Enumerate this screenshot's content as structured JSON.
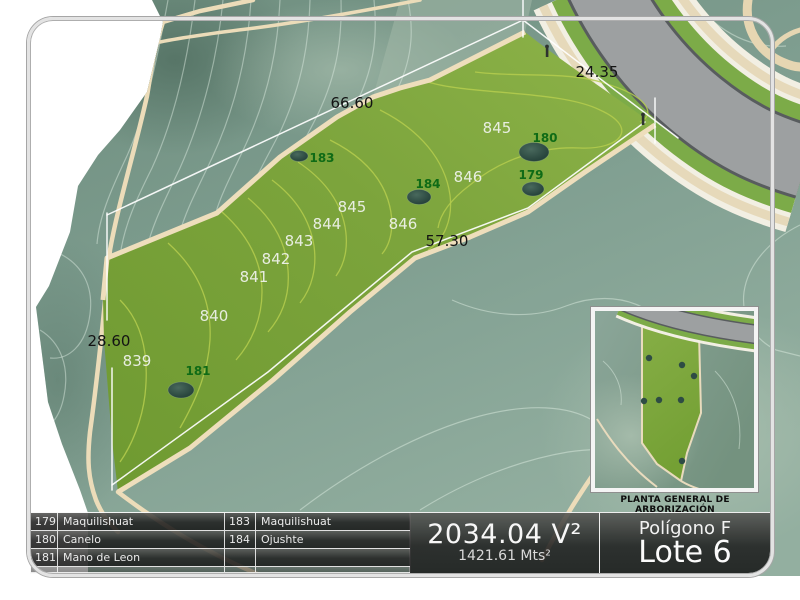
{
  "map": {
    "dimension_labels": [
      "66.60",
      "24.35",
      "57.30",
      "28.60"
    ],
    "elevation_labels": [
      "845",
      "846",
      "845",
      "846",
      "844",
      "843",
      "842",
      "841",
      "840",
      "839"
    ],
    "trees": [
      {
        "id": "179",
        "species": "Maquilishuat"
      },
      {
        "id": "180",
        "species": "Canelo"
      },
      {
        "id": "181",
        "species": "Mano de Leon"
      },
      {
        "id": "183",
        "species": "Maquilishuat"
      },
      {
        "id": "184",
        "species": "Ojushte"
      }
    ]
  },
  "legend_table": {
    "rows": [
      {
        "num1": "179",
        "name1": "Maquilishuat",
        "num2": "183",
        "name2": "Maquilishuat"
      },
      {
        "num1": "180",
        "name1": "Canelo",
        "num2": "184",
        "name2": "Ojushte"
      },
      {
        "num1": "181",
        "name1": "Mano de Leon",
        "num2": "",
        "name2": ""
      },
      {
        "num1": "",
        "name1": "",
        "num2": "",
        "name2": ""
      }
    ]
  },
  "area_panel": {
    "varas": "2034.04 V²",
    "meters": "1421.61 Mts²"
  },
  "title_panel": {
    "poligono": "Polígono F",
    "lote": "Lote 6"
  },
  "inset": {
    "caption": "PLANTA GENERAL DE ARBORIZACIÓN"
  },
  "colors": {
    "lot_green": "#7ca43c",
    "terrain_teal": "#7d9c8e",
    "path_tan": "#ecdcb9",
    "road_gray": "#9da0a1",
    "tree_dark": "#2e4c44",
    "label_green": "#0f6b16",
    "panel_dark": "rgba(30,30,30,0.86)"
  }
}
